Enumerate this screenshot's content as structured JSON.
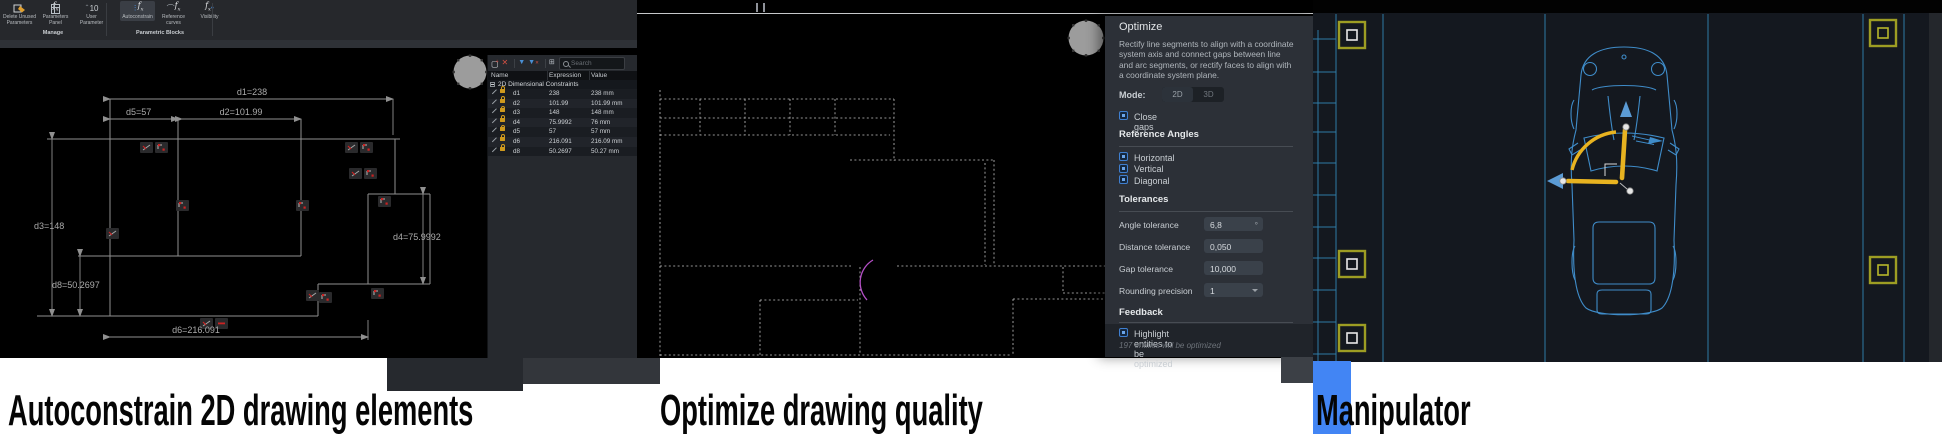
{
  "captions": [
    "Autoconstrain 2D drawing elements",
    "Optimize drawing quality",
    "Manipulator"
  ],
  "colors": {
    "accent_blue": "#4285f4",
    "manipulator_yellow": "#e8b320",
    "marker_olive": "#9d9d23",
    "door_magenta": "#b44fc6",
    "car_blue": "#3f8cc9",
    "checkbox_blue": "#3f7fd0",
    "lock_orange": "#cf9a1e"
  },
  "autoconstrain": {
    "ribbon": {
      "buttons": [
        "Delete Unused Parameters",
        "Parameters Panel",
        "User Parameter",
        "Autoconstrain",
        "Reference curves",
        "Visibility"
      ],
      "groups": [
        "Manage",
        "Parametric Blocks"
      ],
      "user_parameter_icon_text": "10"
    },
    "dims": {
      "d1": "d1=238",
      "d2": "d2=101.99",
      "d3": "d3=148",
      "d4": "d4=75.9992",
      "d5": "d5=57",
      "d6": "d6=216.091",
      "d8": "d8=50.2697"
    },
    "panel": {
      "search_placeholder": "Search",
      "columns": [
        "Name",
        "Expression",
        "Value"
      ],
      "group": "2D Dimensional Constraints",
      "rows": [
        {
          "name": "d1",
          "expr": "238",
          "value": "238 mm"
        },
        {
          "name": "d2",
          "expr": "101.99",
          "value": "101.99 mm"
        },
        {
          "name": "d3",
          "expr": "148",
          "value": "148 mm"
        },
        {
          "name": "d4",
          "expr": "75.9992",
          "value": "76 mm"
        },
        {
          "name": "d5",
          "expr": "57",
          "value": "57 mm"
        },
        {
          "name": "d6",
          "expr": "216.091",
          "value": "216.09 mm"
        },
        {
          "name": "d8",
          "expr": "50.2697",
          "value": "50.27 mm"
        }
      ]
    }
  },
  "optimize": {
    "title": "Optimize",
    "description": "Rectify line segments to align with a coordinate system axis and connect gaps between line and arc segments, or rectify faces to align with a coordinate system plane.",
    "mode_label": "Mode:",
    "modes": [
      "2D",
      "3D"
    ],
    "close_gaps_label": "Close gaps",
    "reference_angles_title": "Reference Angles",
    "reference_angles": [
      "Horizontal",
      "Vertical",
      "Diagonal"
    ],
    "tolerances_title": "Tolerances",
    "fields": [
      {
        "label": "Angle tolerance",
        "value": "6,8",
        "suffix": "°"
      },
      {
        "label": "Distance tolerance",
        "value": "0,050",
        "suffix": ""
      },
      {
        "label": "Gap tolerance",
        "value": "10,000",
        "suffix": ""
      },
      {
        "label": "Rounding precision",
        "value": "1",
        "suffix": ""
      }
    ],
    "feedback_title": "Feedback",
    "feedback_checkbox": "Highlight entities to be optimized",
    "feedback_note": "197 entities will be optimized"
  }
}
